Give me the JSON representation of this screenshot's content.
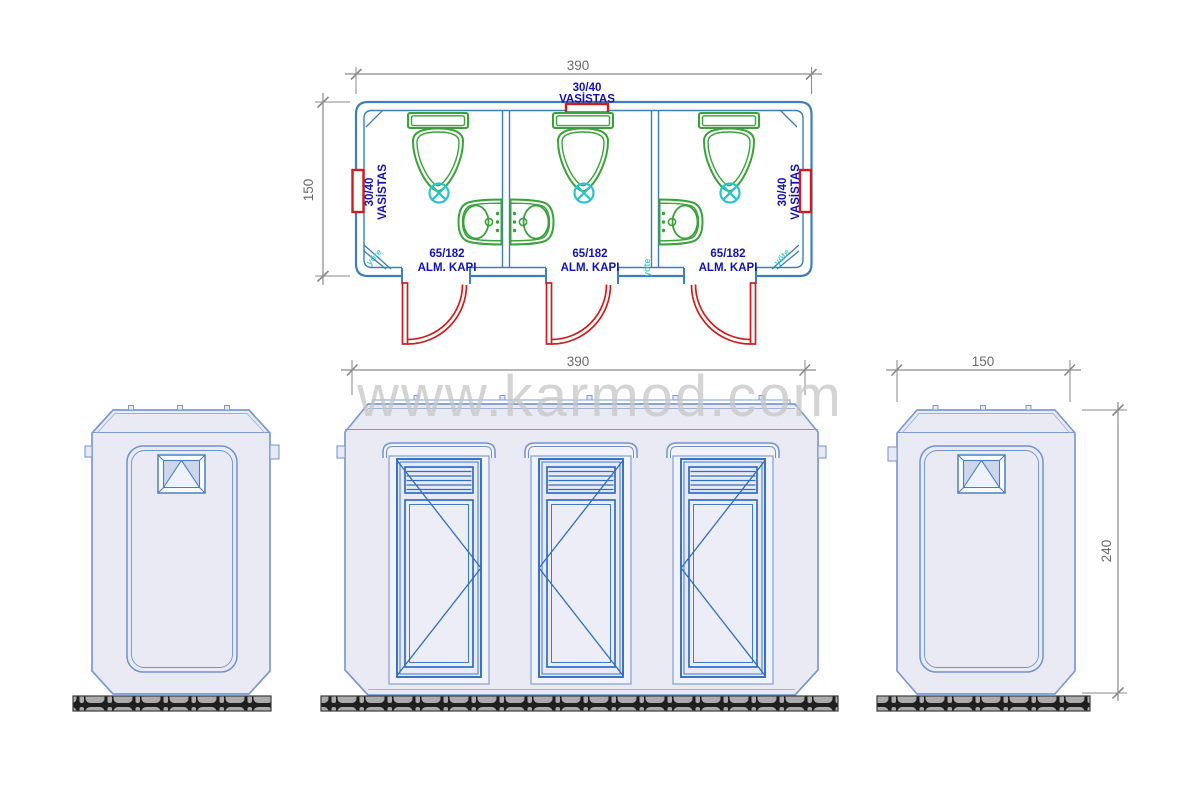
{
  "watermark": {
    "text": "www.karmod.com"
  },
  "plan": {
    "width_label": "390",
    "depth_label": "150",
    "windows": {
      "top": {
        "size": "30/40",
        "type": "VASİSTAS"
      },
      "left": {
        "size": "30/40",
        "type": "VASİSTAS"
      },
      "right": {
        "size": "30/40",
        "type": "VASİSTAS"
      }
    },
    "units": [
      {
        "door_size": "65/182",
        "door_type": "ALM. KAPI"
      },
      {
        "door_size": "65/182",
        "door_type": "ALM. KAPI"
      },
      {
        "door_size": "65/182",
        "door_type": "ALM. KAPI"
      }
    ],
    "corner_marks": [
      "yöte",
      "yöte",
      "yöte"
    ]
  },
  "elevations": {
    "front": {
      "width_label": "390"
    },
    "side": {
      "width_label": "150",
      "height_label": "240"
    }
  },
  "colors": {
    "plan_wall_blue": "#3f7dbd",
    "elevation_blue": "#7b9ad2",
    "door_blue": "#2e6ec4",
    "fixture_green": "#3aa23a",
    "drain_cyan": "#2ac4c8",
    "window_red": "#cf1d1d",
    "label_blue": "#1313b5",
    "dimension_gray": "#6b6b6b",
    "body_fill": "#eaeaf5",
    "watermark_gray": "#c6c6c6",
    "ground_gray": "#ababab"
  }
}
